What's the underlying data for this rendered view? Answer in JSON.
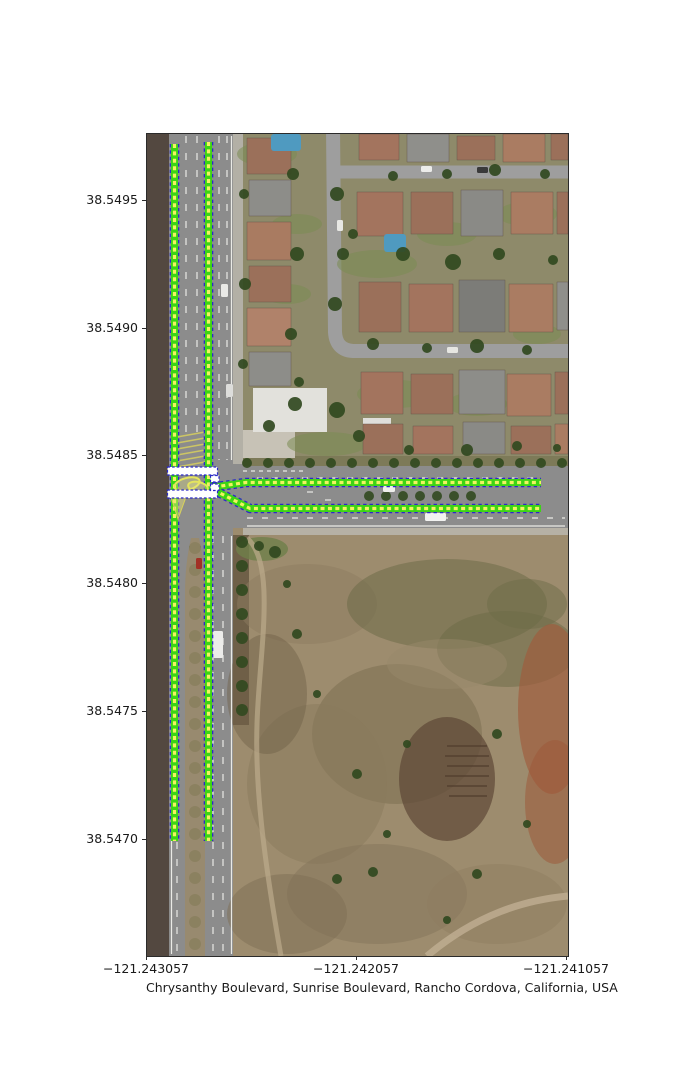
{
  "figure": {
    "xlabel": "Chrysanthy Boulevard, Sunrise Boulevard, Rancho Cordova, California, USA",
    "x_ticks": [
      {
        "label": "−121.243057",
        "x": 146
      },
      {
        "label": "−121.242057",
        "x": 356
      },
      {
        "label": "−121.241057",
        "x": 566
      }
    ],
    "y_ticks": [
      {
        "label": "38.5495",
        "y": 200
      },
      {
        "label": "38.5490",
        "y": 327.7
      },
      {
        "label": "38.5485",
        "y": 455.4
      },
      {
        "label": "38.5480",
        "y": 583.1
      },
      {
        "label": "38.5475",
        "y": 710.8
      },
      {
        "label": "38.5470",
        "y": 838.5
      }
    ],
    "plot_rect": {
      "left": 146,
      "top": 133,
      "width": 421,
      "height": 822
    }
  },
  "colors": {
    "lane_green": "#3cd415",
    "lane_yellow": "#f2f262",
    "lane_blue": "#2a2ac8",
    "crosswalk_white": "#ffffff",
    "loop_yellow": "#e4e45e",
    "road_gray": "#8c8c8c",
    "field_tan": "#9d8c6e",
    "dirt_brown": "#534840",
    "tree_green": "#31491f"
  },
  "map_features": {
    "regions": [
      {
        "x": 0,
        "y": 0,
        "w": 421,
        "h": 822,
        "fill": "#9d8c6e",
        "name": "field-base"
      },
      {
        "x": 92,
        "y": 0,
        "w": 329,
        "h": 330,
        "fill": "#8e8a6a",
        "name": "neighborhood-base"
      },
      {
        "x": 0,
        "y": 0,
        "w": 22,
        "h": 822,
        "fill": "#534840",
        "name": "dirt-strip-west"
      },
      {
        "x": 22,
        "y": 0,
        "w": 64,
        "h": 822,
        "fill": "#8c8c8c",
        "name": "sunrise-blvd-road"
      },
      {
        "x": 86,
        "y": 0,
        "w": 10,
        "h": 330,
        "fill": "#b3b0a6",
        "name": "east-sidewalk"
      },
      {
        "x": 86,
        "y": 330,
        "w": 335,
        "h": 64,
        "fill": "#8c8c8c",
        "name": "chrysanthy-blvd-road"
      },
      {
        "x": 96,
        "y": 322,
        "w": 325,
        "h": 10,
        "fill": "#7d7a58",
        "name": "north-planting-strip"
      },
      {
        "x": 96,
        "y": 394,
        "w": 325,
        "h": 7,
        "fill": "#b6b1a5",
        "name": "south-sidewalk"
      },
      {
        "x": 86,
        "y": 401,
        "w": 16,
        "h": 190,
        "fill": "#6f6048",
        "name": "east-planting-strip-south"
      },
      {
        "x": 96,
        "y": 296,
        "w": 52,
        "h": 28,
        "fill": "#c7c2b6",
        "name": "plaza-concrete"
      },
      {
        "x": 106,
        "y": 254,
        "w": 74,
        "h": 44,
        "fill": "#e2e1dc",
        "name": "white-building"
      },
      {
        "x": 216,
        "y": 284,
        "w": 28,
        "h": 18,
        "fill": "#dfdeda",
        "name": "white-roof-small"
      }
    ],
    "field_patches": [
      {
        "cx": 160,
        "cy": 470,
        "rx": 70,
        "ry": 40,
        "fill": "#8d7c60",
        "op": 0.5
      },
      {
        "cx": 300,
        "cy": 470,
        "rx": 100,
        "ry": 45,
        "fill": "#6e6b48",
        "op": 0.55
      },
      {
        "cx": 360,
        "cy": 515,
        "rx": 70,
        "ry": 38,
        "fill": "#6c6946",
        "op": 0.5
      },
      {
        "cx": 380,
        "cy": 470,
        "rx": 40,
        "ry": 25,
        "fill": "#6e6b48",
        "op": 0.5
      },
      {
        "cx": 250,
        "cy": 600,
        "rx": 85,
        "ry": 70,
        "fill": "#7c6f52",
        "op": 0.55
      },
      {
        "cx": 170,
        "cy": 650,
        "rx": 70,
        "ry": 80,
        "fill": "#8a795c",
        "op": 0.5
      },
      {
        "cx": 405,
        "cy": 575,
        "rx": 34,
        "ry": 85,
        "fill": "#a05a3c",
        "op": 0.65
      },
      {
        "cx": 408,
        "cy": 668,
        "rx": 30,
        "ry": 62,
        "fill": "#9c5a3a",
        "op": 0.55
      },
      {
        "cx": 300,
        "cy": 645,
        "rx": 48,
        "ry": 62,
        "fill": "#5e4736",
        "op": 0.7
      },
      {
        "cx": 230,
        "cy": 760,
        "rx": 90,
        "ry": 50,
        "fill": "#84745a",
        "op": 0.5
      },
      {
        "cx": 350,
        "cy": 770,
        "rx": 70,
        "ry": 40,
        "fill": "#8d7c60",
        "op": 0.45
      },
      {
        "cx": 140,
        "cy": 780,
        "rx": 60,
        "ry": 40,
        "fill": "#7e6e54",
        "op": 0.5
      },
      {
        "cx": 120,
        "cy": 560,
        "rx": 40,
        "ry": 60,
        "fill": "#6f6048",
        "op": 0.45
      },
      {
        "cx": 300,
        "cy": 530,
        "rx": 60,
        "ry": 25,
        "fill": "#98876a",
        "op": 0.5
      },
      {
        "cx": 115,
        "cy": 415,
        "rx": 26,
        "ry": 12,
        "fill": "#6f7f4a",
        "op": 0.8
      }
    ],
    "field_paths": [
      {
        "d": "M 100,404 C 130,430 112,520 110,590 C 108,650 116,720 134,822",
        "stroke": "#bcab8c",
        "w": 5,
        "op": 0.7
      },
      {
        "d": "M 280,822 C 330,780 378,766 421,762",
        "stroke": "#c3b296",
        "w": 7,
        "op": 0.75
      },
      {
        "d": "M 300,612 l 40,0 M 298,622 l 44,0 M 300,632 l 42,0 M 298,642 l 44,0 M 300,652 l 40,0 M 302,662 l 38,0",
        "stroke": "#4e3a2c",
        "w": 2,
        "op": 0.6
      }
    ],
    "streets": [
      {
        "d": "M 186,-6 L 188,198 Q 189,216 206,217 L 421,217",
        "w": 14
      },
      {
        "d": "M 188,38 L 421,38",
        "w": 13
      }
    ],
    "houses": [
      [
        100,
        4,
        44,
        36,
        "#9b705a"
      ],
      [
        102,
        46,
        42,
        36,
        "#8d8d89"
      ],
      [
        100,
        88,
        44,
        38,
        "#a97b61"
      ],
      [
        102,
        132,
        42,
        36,
        "#9b705a"
      ],
      [
        100,
        174,
        44,
        38,
        "#b0826a"
      ],
      [
        102,
        218,
        42,
        34,
        "#8d8d89"
      ],
      [
        212,
        0,
        40,
        26,
        "#a3745e"
      ],
      [
        260,
        0,
        42,
        28,
        "#8f8f8b"
      ],
      [
        310,
        2,
        38,
        24,
        "#9b705a"
      ],
      [
        356,
        0,
        42,
        28,
        "#aa7c62"
      ],
      [
        404,
        0,
        17,
        26,
        "#9b705a"
      ],
      [
        210,
        58,
        46,
        44,
        "#a3745e"
      ],
      [
        264,
        58,
        42,
        42,
        "#9b705a"
      ],
      [
        314,
        56,
        42,
        46,
        "#8a8a86"
      ],
      [
        364,
        58,
        42,
        42,
        "#aa7c62"
      ],
      [
        410,
        58,
        11,
        42,
        "#9b705a"
      ],
      [
        212,
        148,
        42,
        50,
        "#9b705a"
      ],
      [
        262,
        150,
        44,
        48,
        "#a3745e"
      ],
      [
        312,
        146,
        46,
        52,
        "#7c7c78"
      ],
      [
        362,
        150,
        44,
        48,
        "#aa7c62"
      ],
      [
        410,
        148,
        11,
        48,
        "#8f8f8b"
      ],
      [
        214,
        238,
        42,
        42,
        "#a3745e"
      ],
      [
        264,
        240,
        42,
        40,
        "#9b705a"
      ],
      [
        312,
        236,
        46,
        44,
        "#8d8d89"
      ],
      [
        360,
        240,
        44,
        42,
        "#aa7c62"
      ],
      [
        408,
        238,
        13,
        42,
        "#9b705a"
      ],
      [
        216,
        290,
        40,
        30,
        "#9b705a"
      ],
      [
        266,
        292,
        40,
        28,
        "#a3745e"
      ],
      [
        316,
        288,
        42,
        32,
        "#8a8a86"
      ],
      [
        364,
        292,
        40,
        28,
        "#9b705a"
      ],
      [
        408,
        290,
        13,
        30,
        "#aa7c62"
      ]
    ],
    "lawns": [
      [
        120,
        20,
        30,
        12
      ],
      [
        150,
        90,
        25,
        10
      ],
      [
        230,
        130,
        40,
        14
      ],
      [
        300,
        100,
        30,
        12
      ],
      [
        380,
        80,
        30,
        12
      ],
      [
        250,
        260,
        40,
        14
      ],
      [
        330,
        270,
        30,
        12
      ],
      [
        180,
        310,
        40,
        12
      ],
      [
        390,
        200,
        24,
        10
      ],
      [
        140,
        160,
        24,
        10
      ]
    ],
    "pools": [
      [
        124,
        0,
        30,
        17
      ],
      [
        237,
        100,
        22,
        18
      ]
    ],
    "trees": [
      [
        190,
        60,
        7
      ],
      [
        196,
        120,
        6
      ],
      [
        188,
        170,
        7
      ],
      [
        206,
        100,
        5
      ],
      [
        246,
        42,
        5
      ],
      [
        300,
        40,
        5
      ],
      [
        348,
        36,
        6
      ],
      [
        398,
        40,
        5
      ],
      [
        256,
        120,
        7
      ],
      [
        306,
        128,
        8
      ],
      [
        352,
        120,
        6
      ],
      [
        406,
        126,
        5
      ],
      [
        226,
        210,
        6
      ],
      [
        280,
        214,
        5
      ],
      [
        330,
        212,
        7
      ],
      [
        380,
        216,
        5
      ],
      [
        146,
        40,
        6
      ],
      [
        150,
        120,
        7
      ],
      [
        144,
        200,
        6
      ],
      [
        152,
        248,
        5
      ],
      [
        97,
        60,
        5
      ],
      [
        98,
        150,
        6
      ],
      [
        96,
        230,
        5
      ],
      [
        212,
        302,
        6
      ],
      [
        262,
        316,
        5
      ],
      [
        320,
        316,
        6
      ],
      [
        370,
        312,
        5
      ],
      [
        410,
        314,
        4
      ],
      [
        148,
        270,
        7
      ],
      [
        190,
        276,
        8
      ],
      [
        122,
        292,
        6
      ],
      [
        150,
        500,
        5
      ],
      [
        170,
        560,
        4
      ],
      [
        210,
        640,
        5
      ],
      [
        240,
        700,
        4
      ],
      [
        190,
        745,
        5
      ],
      [
        350,
        600,
        5
      ],
      [
        380,
        690,
        4
      ],
      [
        330,
        740,
        5
      ],
      [
        300,
        786,
        4
      ],
      [
        260,
        610,
        4
      ],
      [
        140,
        450,
        4
      ],
      [
        128,
        418,
        6
      ],
      [
        112,
        412,
        5
      ],
      [
        226,
        738,
        5
      ]
    ],
    "tree_rows": [
      {
        "x0": 100,
        "x1": 418,
        "y": 329,
        "step": 21,
        "r": 5,
        "axis": "x"
      },
      {
        "x0": 222,
        "x1": 336,
        "y": 362,
        "step": 17,
        "r": 5,
        "axis": "x"
      },
      {
        "y0": 414,
        "y1": 818,
        "x": 48,
        "step": 22,
        "r": 6,
        "axis": "y"
      },
      {
        "y0": 408,
        "y1": 580,
        "x": 95,
        "step": 24,
        "r": 6,
        "axis": "y"
      }
    ],
    "road_markings": [
      {
        "x1": 39,
        "y1": 2,
        "x2": 39,
        "y2": 300,
        "dash": "7 10"
      },
      {
        "x1": 50,
        "y1": 2,
        "x2": 50,
        "y2": 300,
        "dash": "7 10"
      },
      {
        "x1": 72,
        "y1": 2,
        "x2": 72,
        "y2": 326,
        "dash": "7 10"
      },
      {
        "x1": 80,
        "y1": 2,
        "x2": 80,
        "y2": 326,
        "dash": "7 10"
      },
      {
        "x1": 84.5,
        "y1": 2,
        "x2": 84.5,
        "y2": 326,
        "dash": ""
      },
      {
        "x1": 30,
        "y1": 402,
        "x2": 30,
        "y2": 820,
        "dash": "7 10"
      },
      {
        "x1": 66,
        "y1": 402,
        "x2": 66,
        "y2": 820,
        "dash": "7 10"
      },
      {
        "x1": 76,
        "y1": 402,
        "x2": 76,
        "y2": 820,
        "dash": "7 10"
      },
      {
        "x1": 84.5,
        "y1": 402,
        "x2": 84.5,
        "y2": 820,
        "dash": ""
      },
      {
        "x1": 24.5,
        "y1": 402,
        "x2": 24.5,
        "y2": 820,
        "dash": ""
      },
      {
        "x1": 110,
        "y1": 344,
        "x2": 390,
        "y2": 344,
        "dash": "6 9"
      },
      {
        "x1": 100,
        "y1": 384,
        "x2": 418,
        "y2": 384,
        "dash": "6 9"
      },
      {
        "x1": 100,
        "y1": 392,
        "x2": 418,
        "y2": 392,
        "dash": ""
      },
      {
        "x1": 160,
        "y1": 358,
        "x2": 166,
        "y2": 358,
        "dash": ""
      },
      {
        "x1": 178,
        "y1": 366,
        "x2": 184,
        "y2": 366,
        "dash": ""
      },
      {
        "x1": 96,
        "y1": 337,
        "x2": 160,
        "y2": 337,
        "dash": "4 4"
      }
    ],
    "median_hatch": {
      "x": 30,
      "y": 298,
      "w": 28,
      "h": 32,
      "stroke": "#d8cf5e"
    },
    "vehicles": [
      [
        66,
        497,
        10,
        27,
        "#ececea"
      ],
      [
        278,
        379,
        21,
        8,
        "#f2f2f0"
      ],
      [
        49,
        424,
        6,
        11,
        "#a23126"
      ],
      [
        190,
        86,
        6,
        11,
        "#e8e8e4"
      ],
      [
        330,
        33,
        11,
        6,
        "#3a3a3a"
      ],
      [
        274,
        32,
        11,
        6,
        "#ececea"
      ],
      [
        300,
        213,
        11,
        6,
        "#e6e6e2"
      ],
      [
        236,
        352,
        12,
        6,
        "#efefec"
      ],
      [
        74,
        150,
        7,
        13,
        "#e9e9e6"
      ],
      [
        79,
        250,
        7,
        13,
        "#dddddb"
      ]
    ]
  },
  "annotations": {
    "lane_lines": [
      {
        "name": "sunrise-west-lane",
        "pts": [
          [
            27.5,
            10
          ],
          [
            27.5,
            707
          ]
        ]
      },
      {
        "name": "sunrise-east-lane",
        "pts": [
          [
            61.5,
            8
          ],
          [
            61.5,
            707
          ]
        ]
      },
      {
        "name": "chrysanthy-north-lane",
        "pts": [
          [
            67,
            353
          ],
          [
            99,
            348.5
          ],
          [
            394,
            348.5
          ]
        ]
      },
      {
        "name": "chrysanthy-south-lane",
        "pts": [
          [
            67,
            356
          ],
          [
            103,
            374.5
          ],
          [
            394,
            374.5
          ]
        ]
      }
    ],
    "crosswalks": [
      {
        "x": 20.5,
        "y": 333,
        "w": 50,
        "h": 8
      },
      {
        "x": 20.5,
        "y": 356,
        "w": 50,
        "h": 8
      },
      {
        "x": 63.5,
        "y": 341.5,
        "w": 8.5,
        "h": 6.5
      },
      {
        "x": 63.5,
        "y": 350,
        "w": 8.5,
        "h": 6.5
      }
    ],
    "turn_loops": [
      {
        "cx": 40,
        "cy": 350,
        "rx": 13,
        "ry": 6,
        "rot": -15
      },
      {
        "cx": 51,
        "cy": 353,
        "rx": 10,
        "ry": 5,
        "rot": 12
      }
    ],
    "turn_wedge": [
      [
        24,
        363
      ],
      [
        39,
        363
      ],
      [
        31,
        385
      ]
    ]
  }
}
